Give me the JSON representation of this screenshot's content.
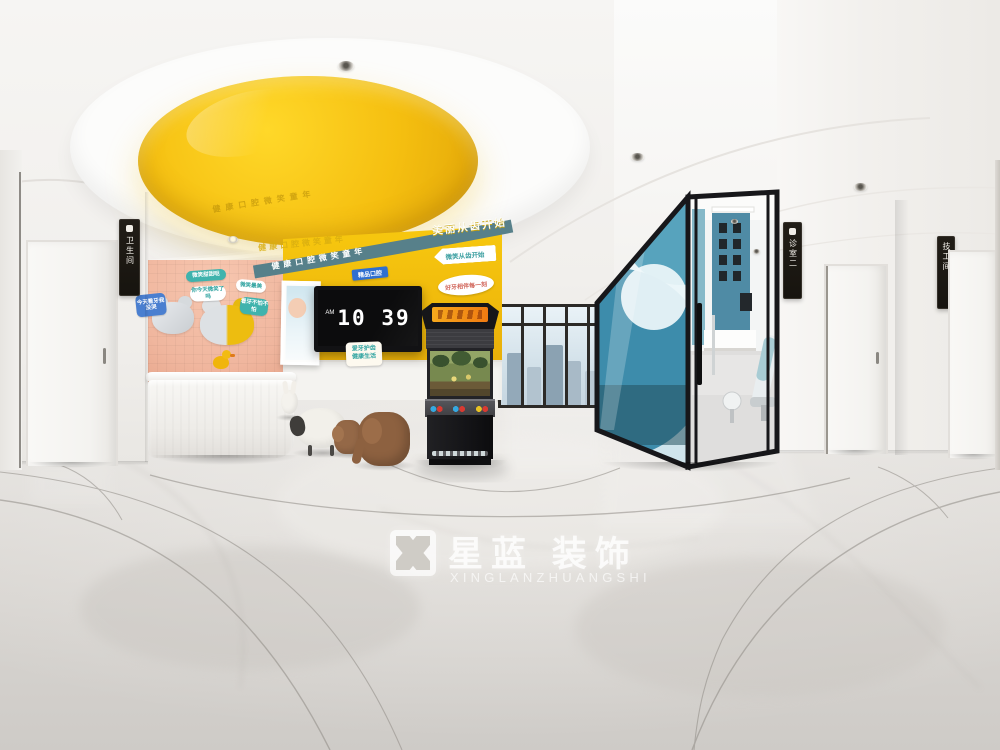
{
  "watermark": {
    "brand": "星蓝 装饰",
    "romanized": "XINGLANZHUANGSHI"
  },
  "tv_clock": {
    "meridiem": "AM",
    "time": "10 39"
  },
  "door_signs": {
    "restroom": "卫生间",
    "clinic_room": "诊室二",
    "tech_room": "技工间"
  },
  "wall_slogans": {
    "dome_reflection": "健康口腔微笑童年",
    "embossed": "健康口腔微笑童年",
    "band": "健康口腔微笑童年",
    "beauty": "美丽从齿开始",
    "boutique_label": "精品口腔",
    "arrow_sign": "微笑从齿开始",
    "oval_sign": "好牙相伴每一刻",
    "tv_sign_line1": "爱牙护齿",
    "tv_sign_line2": "健康生活"
  },
  "bubbles": [
    {
      "label": "今天看牙我没哭"
    },
    {
      "label": "微笑甜甜哒"
    },
    {
      "label": "你今天微笑了吗"
    },
    {
      "label": "微笑最美"
    },
    {
      "label": "看牙不怕不怕"
    }
  ],
  "colors": {
    "accent_yellow": "#f2c20e",
    "accent_teal": "#57808a",
    "accent_blue": "#4f8ba5",
    "accent_pink": "#f3bda6"
  }
}
